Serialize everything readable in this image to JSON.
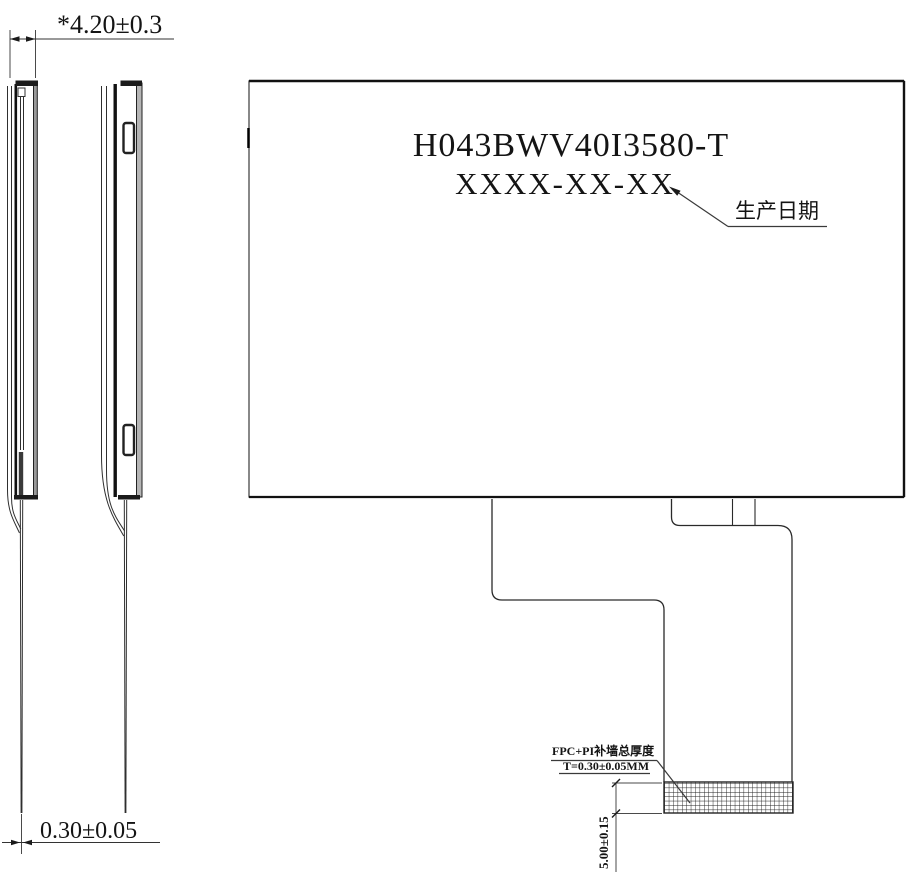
{
  "drawing": {
    "labels": {
      "part_number": "H043BWV40I3580-T",
      "date_placeholder": "XXXX-XX-XX",
      "production_date": "生产日期",
      "fpc_note_line1": "FPC+PI补墙总厚度",
      "fpc_note_line2": "T=0.30±0.05MM"
    },
    "dims": {
      "total_thickness": "*4.20±0.3",
      "fpc_thickness": "0.30±0.05",
      "stiffener_height": "5.00±0.15"
    },
    "colors": {
      "line": "#1a1a1a",
      "thin_line": "#4a4a4a",
      "background": "#ffffff"
    }
  }
}
